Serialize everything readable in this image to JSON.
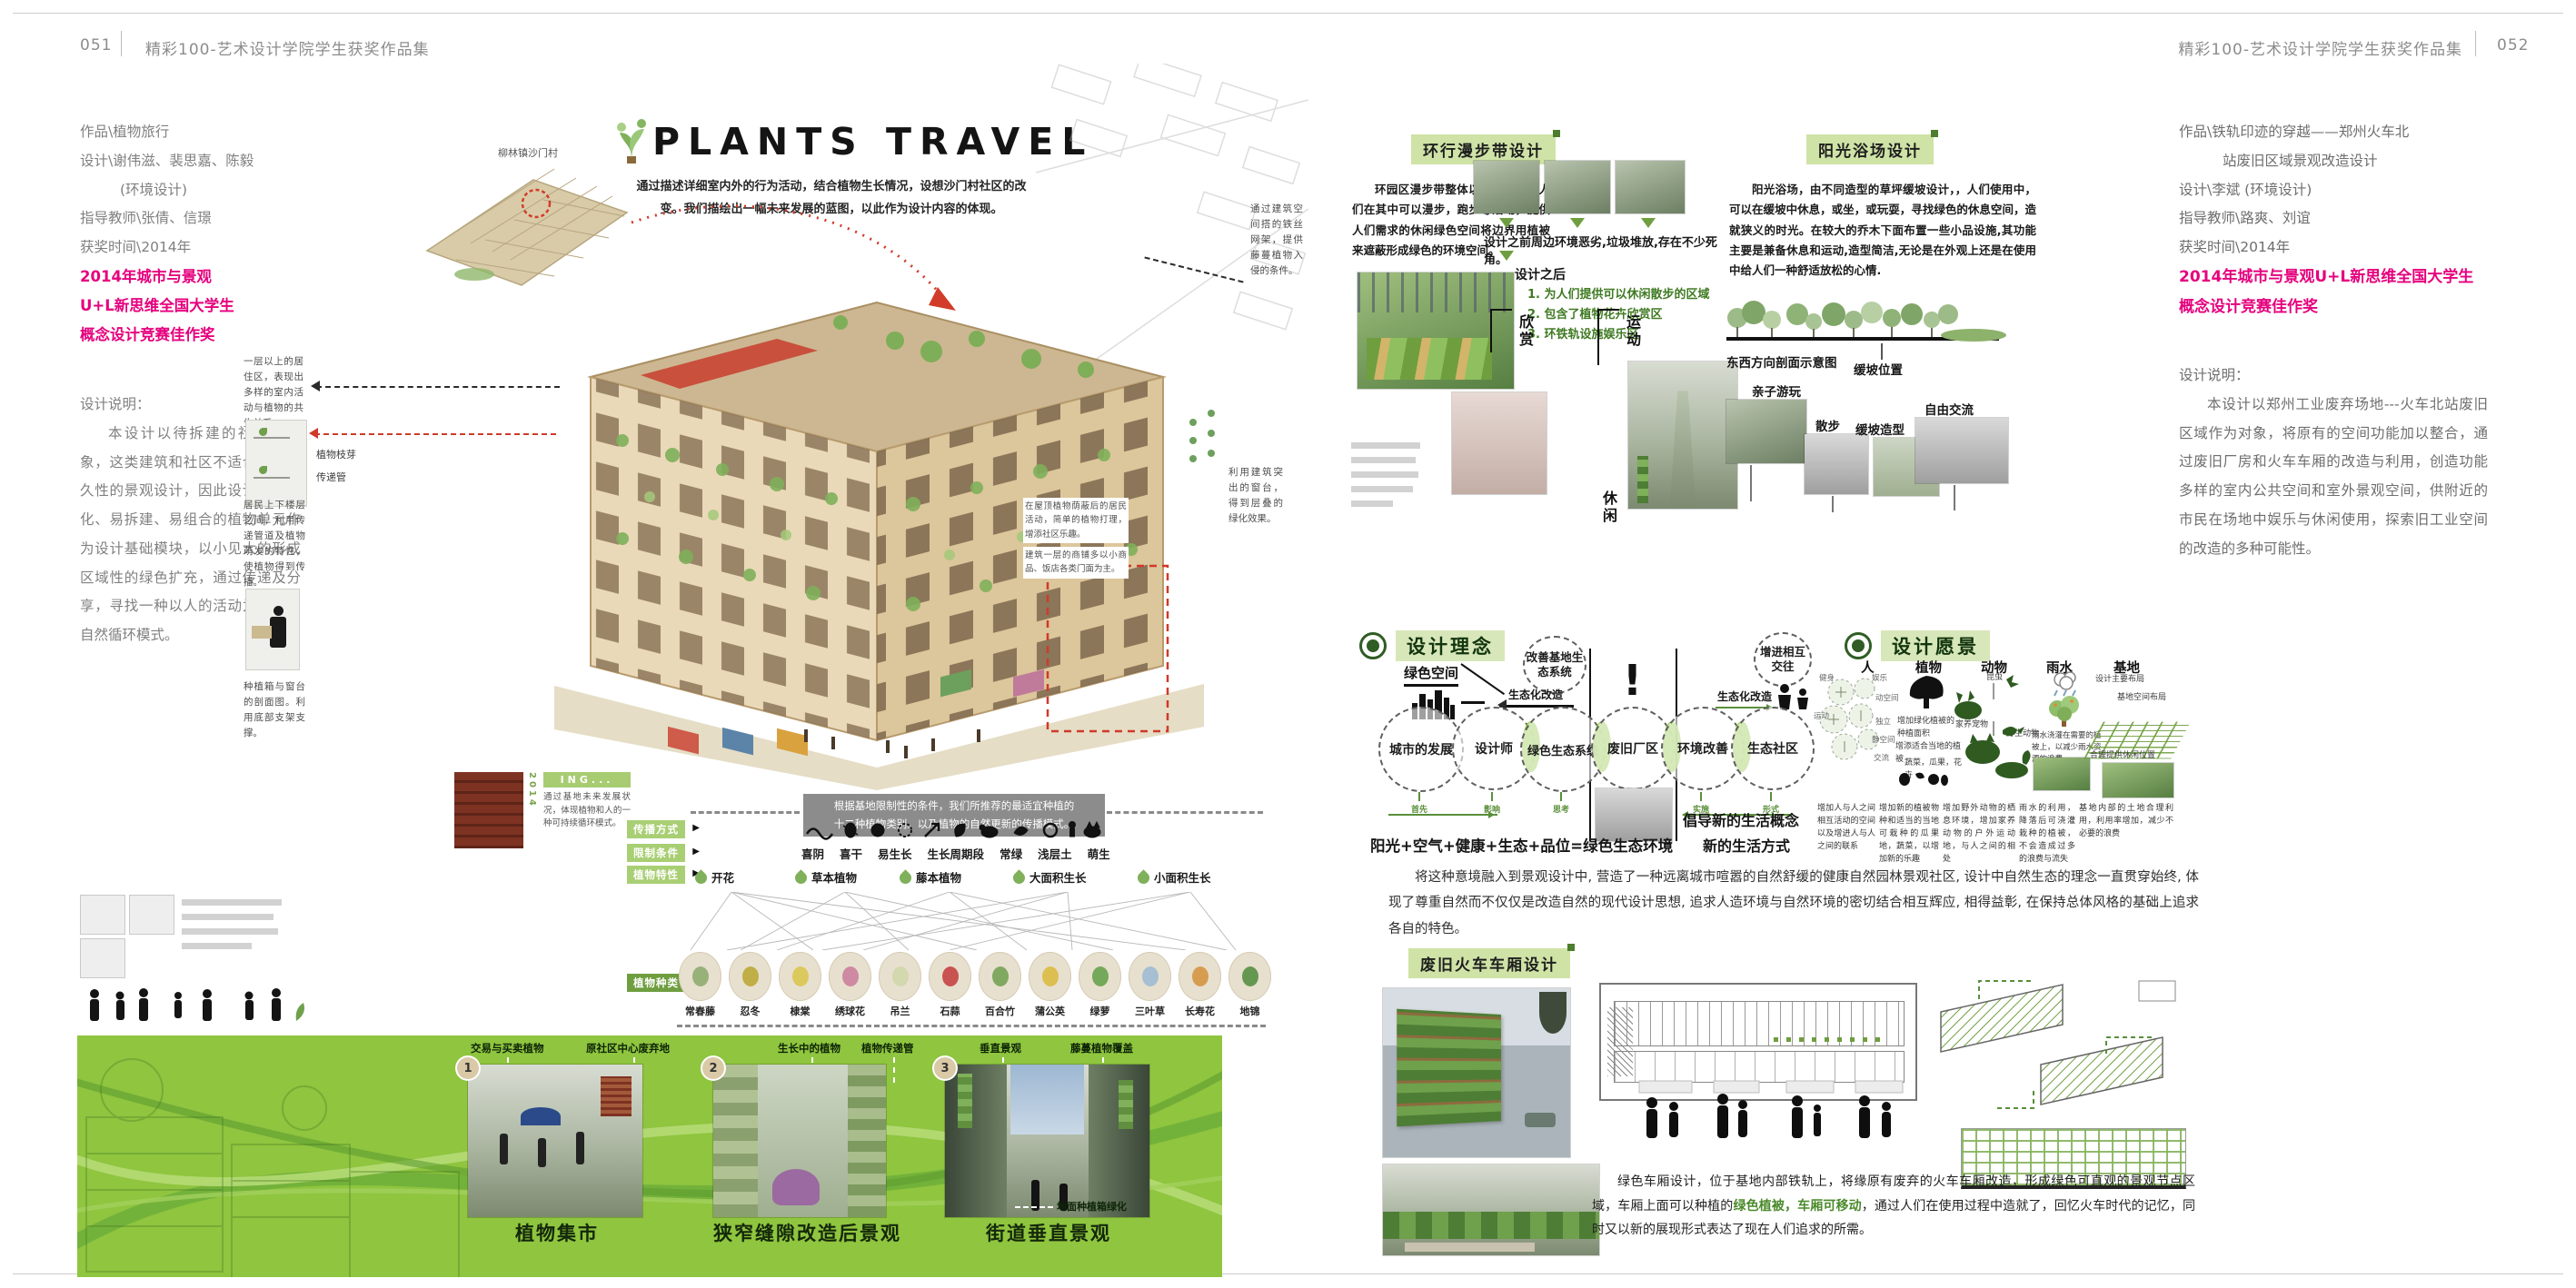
{
  "left": {
    "header": {
      "page_num": "051",
      "book_title": "精彩100-艺术设计学院学生获奖作品集"
    },
    "info": {
      "work": "作品\\植物旅行",
      "designers": "设计\\谢伟滋、裴思嘉、陈毅",
      "dept": "(环境设计)",
      "advisors": "指导教师\\张倩、信璟",
      "award_time": "获奖时间\\2014年",
      "award_lines": [
        "2014年城市与景观",
        "U+L新思维全国大学生",
        "概念设计竞赛佳作奖"
      ],
      "desc_title": "设计说明：",
      "desc": "本设计以待拆建的社区为对象，这类建筑和社区不适合进行永久性的景观设计，因此设计以模块化、易拆建、易组合的植物单元作为设计基础模块，以小见大的形成区域性的绿色扩充，通过传递及分享，寻找一种以人的活动为基础的自然循环模式。"
    },
    "hero": {
      "title": "PLANTS TRAVEL",
      "subtitle": "通过描述详细室内外的行为活动，结合植物生长情况，设想沙门村社区的改变。我们描绘出一幅未来发展的蓝图，以此作为设计内容的体现。",
      "site_label": "柳林镇沙门村"
    },
    "callouts": {
      "upper_left": "一层以上的居住区，表现出多样的室内活动与植物的共生关系。",
      "branch": "植物枝芽",
      "pipe": "传递管",
      "mid_left": "居民上下楼层之间，利用传递管道及植物萌发的特性，使植物得到传播。",
      "lower_left": "种植箱与窗台的剖面图。利用底部支架支撑。",
      "upper_right": "通过建筑空间搭的铁丝网架，提供藤蔓植物入侵的条件。",
      "mid_right": "利用建筑突出的窗台，得到层叠的绿化效果。",
      "base_a": "在屋顶植物荫蔽后的居民活动，简单的植物打理，增添社区乐趣。",
      "base_b": "建筑一层的商铺多以小商品、饭店各类门面为主。",
      "ing_year": "2014",
      "ing_tag": "ING...",
      "ing_text": "通过基地未来发展状况，体现植物和人的一种可持续循环模式。"
    },
    "matrix": {
      "banner_line1": "根据基地限制性的条件，我们所推荐的最适宜种植的",
      "banner_line2": "十二种植物类别。以及植物的自然更新的传播模式。",
      "row_labels": [
        "传播方式",
        "限制条件",
        "植物特性",
        "植物种类"
      ],
      "conditions": [
        "喜阴",
        "喜干",
        "易生长",
        "生长周期段",
        "常绿",
        "浅层土",
        "萌生"
      ],
      "traits": [
        "开花",
        "草本植物",
        "藤本植物",
        "大面积生长",
        "小面积生长"
      ],
      "species": [
        "常春藤",
        "忍冬",
        "棣棠",
        "绣球花",
        "吊兰",
        "石蒜",
        "百合竹",
        "蒲公英",
        "绿萝",
        "三叶草",
        "长寿花",
        "地锦"
      ]
    },
    "banner": {
      "panel1": {
        "num": "1",
        "caption": "植物集市",
        "label_a": "交易与买卖植物",
        "label_b": "原社区中心废弃地"
      },
      "panel2": {
        "num": "2",
        "caption": "狭窄缝隙改造后景观",
        "label_a": "生长中的植物",
        "label_b": "植物传递管"
      },
      "panel3": {
        "num": "3",
        "caption": "街道垂直景观",
        "label_a": "垂直景观",
        "label_b": "藤蔓植物覆盖",
        "label_c": "地面种植箱绿化"
      }
    }
  },
  "right": {
    "header": {
      "book_title": "精彩100-艺术设计学院学生获奖作品集",
      "page_num": "052"
    },
    "info": {
      "work_l1": "作品\\铁轨印迹的穿越——郑州火车北",
      "work_l2": "站废旧区域景观改造设计",
      "designers": "设计\\李斌 (环境设计)",
      "advisors": "指导教师\\路爽、刘谊",
      "award_time": "获奖时间\\2014年",
      "award_lines": [
        "2014年城市与景观U+L新思维全国大学生",
        "概念设计竞赛佳作奖"
      ],
      "desc_title": "设计说明：",
      "desc": "本设计以郑州工业废弃场地---火车北站废旧区域作为对象，将原有的空间功能加以整合，通过废旧厂房和火车车厢的改造与利用，创造功能多样的室内公共空间和室外景观空间，供附近的市民在场地中娱乐与休闲使用，探索旧工业空间的改造的多种可能性。"
    },
    "walk": {
      "header": "环行漫步带设计",
      "para": "环园区漫步带整体以绿色围合，人们在其中可以漫步，跑步等活动，提供人们需求的休闲绿色空间将边界用植被来遮蔽形成绿色的环境空间。",
      "before_caption": "设计之前周边环境恶劣,垃圾堆放,存在不少死角。",
      "after_title": "设计之后",
      "after_1": "1. 为人们提供可以休闲散步的区域",
      "after_2": "2. 包含了植物花卉欣赏区",
      "after_3": "3. 环铁轨设施娱乐区",
      "tag_view": "欣赏",
      "tag_sport": "运动",
      "tag_rest": "休闲"
    },
    "sun": {
      "header": "阳光浴场设计",
      "para": "阳光浴场，由不同造型的草坪缓坡设计，，人们使用中，可以在缓坡中休息，或坐，或玩耍，寻找绿色的休息空间，造就狭义的时光。在较大的乔木下面布置一些小品设施,其功能主要是兼备休息和运动,造型简洁,无论是在外观上还是在使用中给人们一种舒适放松的心情.",
      "section_label": "东西方向剖面示意图",
      "slope_label": "缓坡位置",
      "label_family": "亲子游玩",
      "label_walk": "散步",
      "label_slope": "缓坡造型",
      "label_chat": "自由交流"
    },
    "concept": {
      "header": "设计理念",
      "green_space": "绿色空间",
      "improve": "改善基地生态系统",
      "eco_a": "生态化改造",
      "eco_b": "生态化改造",
      "promote": "增进相互交往",
      "exclaim": "!",
      "circles": [
        "城市的发展",
        "设计师",
        "绿色生态系统",
        "废旧厂区",
        "环境改善",
        "生态社区"
      ],
      "steps": [
        "首先",
        "影响",
        "思考",
        "考虑的问题",
        "实施",
        "形式"
      ],
      "formula": "阳光+空气+健康+生态+品位=绿色生态环境",
      "advocate_l1": "倡导新的生活概念",
      "advocate_l2": "新的生活方式"
    },
    "vision": {
      "header": "设计愿景",
      "t_person": "人",
      "t_plant": "植物",
      "t_animal": "动物",
      "t_rain": "雨水",
      "t_site": "基地",
      "person_bubbles": [
        "健身",
        "娱乐",
        "动空间",
        "运动",
        "独立",
        "静空间",
        "交流"
      ],
      "plant_note1": "增加绿化植被的种植面积",
      "plant_note2": "增添适合当地的植被",
      "plant_note3": "蔬菜，瓜果，花卉",
      "animal_note1": "昆虫",
      "animal_note2": "家养宠物",
      "animal_note3": "野生动物",
      "rain_note": "雨水浇灌在需要的植被上，以减少雨水资源的浪费",
      "site_note1": "设计主要布局",
      "site_note2": "基地空间布局",
      "site_note3": "合理提供休闲位置",
      "cap_person": "增加人与人之间相互活动的空间以及增进人与人之间的联系",
      "cap_plant": "增加新的植被物种和适当的当地可栽种的瓜果地，蔬菜，以增加新的乐趣",
      "cap_animal": "增加野外动物的栖息环境，增加家养动物的户外运动地，与人之间的相处",
      "cap_rain": "雨水的利用，降落后可浇灌栽种的植被，不会造成过多的浪费与流失",
      "cap_site": "基地内部的土地合理利用，利用率增加，减少不必要的浪费"
    },
    "mid_para": "将这种意境融入到景观设计中, 营造了一种远离城市喧嚣的自然舒缓的健康自然园林景观社区, 设计中自然生态的理念一直贯穿始终, 体现了尊重自然而不仅仅是改造自然的现代设计思想, 追求人造环境与自然环境的密切结合相互辉应, 相得益彰, 在保持总体风格的基础上追求各自的特色。",
    "carriage": {
      "header": "废旧火车车厢设计",
      "cap_pre": "绿色车厢设计，位于基地内部铁轨上，将缘原有废弃的火车车厢改造，形成绿色可直观的景观节点区域，车厢上面可以种植的",
      "cap_green": "绿色植被，车厢可移动",
      "cap_post": "，通过人们在使用过程中造就了，回忆火车时代的记忆，同时又以新的展现形式表达了现在人们追求的所需。"
    }
  }
}
